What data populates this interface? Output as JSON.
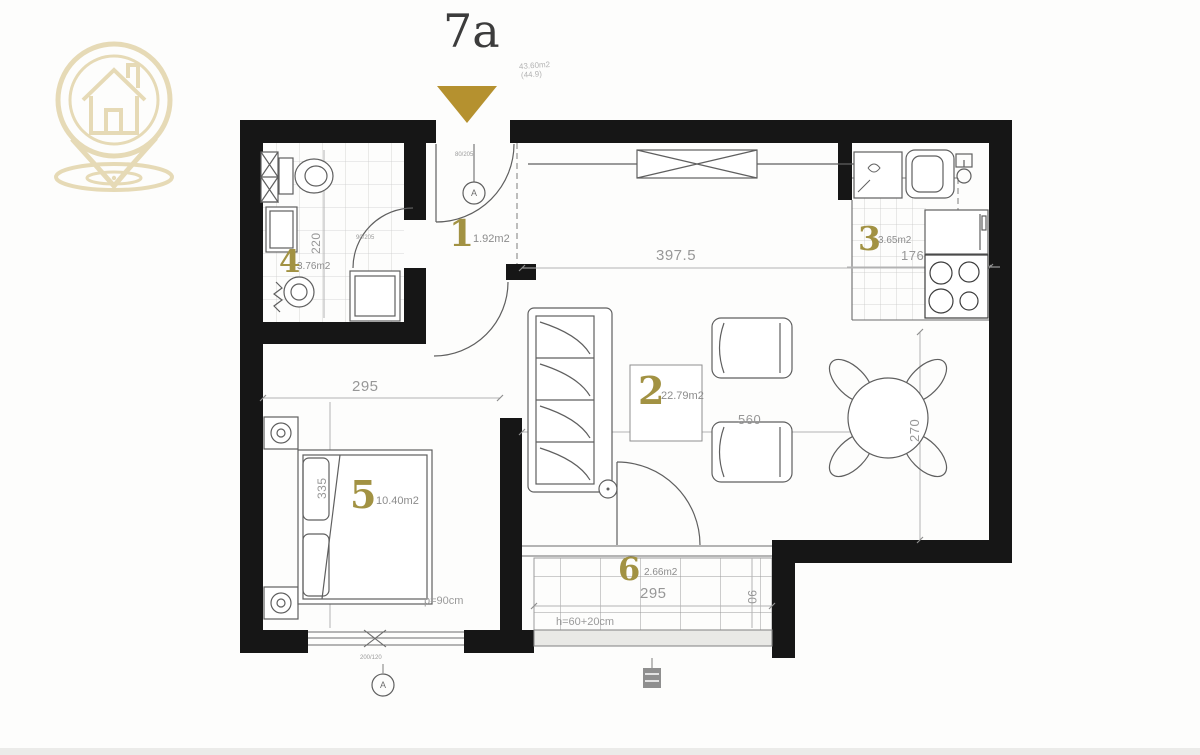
{
  "colors": {
    "accent_gold": "#b5912f",
    "logo_tan": "#e6dab6",
    "room_number_gold": "#a29243",
    "wall_black": "#161616"
  },
  "header": {
    "title": "7a",
    "area_note_line1": "43.60m2",
    "area_note_line2": "(44.9)"
  },
  "rooms": [
    {
      "number": "1",
      "area": "1.92m2"
    },
    {
      "number": "2",
      "area": "22.79m2"
    },
    {
      "number": "3",
      "area": "3.65m2"
    },
    {
      "number": "4",
      "area": "3.76m2"
    },
    {
      "number": "5",
      "area": "10.40m2"
    },
    {
      "number": "6",
      "area": "2.66m2"
    }
  ],
  "dimensions": {
    "living_width": "397.5",
    "bedroom_width": "295",
    "living_length": "560",
    "dining_depth": "270",
    "kitchen_width": "176",
    "bathroom_depth": "220",
    "bedroom_depth": "335",
    "balcony_width": "295",
    "balcony_depth": "90",
    "window_parapet": "p=90cm",
    "balcony_parapet": "h=60+20cm"
  },
  "annotations": {
    "entry_door_size": "80/205",
    "bathroom_door_size": "90/205",
    "bedroom_window_size": "200/120",
    "entry_marker": "A",
    "window_marker": "A"
  }
}
